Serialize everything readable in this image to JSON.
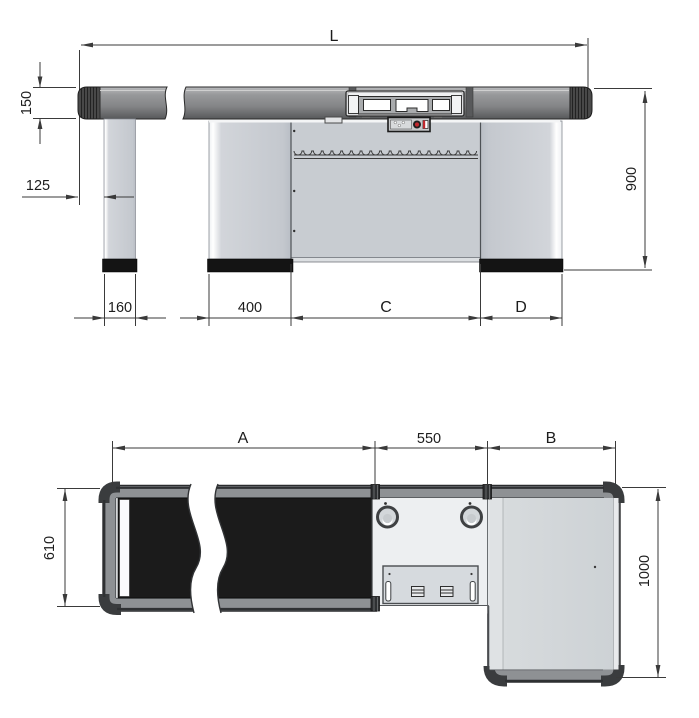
{
  "drawing": {
    "views": {
      "front_elevation": {
        "dims": {
          "overall_length": "L",
          "rail_height": "150",
          "rail_overhang": "125",
          "counter_height": "900",
          "leg_width": "160",
          "left_cabinet_width": "400",
          "center_width": "C",
          "right_cabinet_width": "D"
        }
      },
      "top_plan": {
        "dims": {
          "belt_length": "A",
          "center_section_width": "550",
          "end_section_width": "B",
          "counter_depth": "610",
          "end_depth": "1000"
        }
      }
    },
    "colors": {
      "line": "#3a3a3a",
      "text": "#1c1c1c",
      "bumper": "#8e9194",
      "bumper_dark": "#2f3133",
      "corner": "#3a3c3e",
      "panel": "#c9cdd3",
      "deck": "#e4e7e9",
      "deck_light": "#edeff1",
      "belt": "#1b1b1b",
      "base": "#141414",
      "button_red": "#c1272d"
    }
  }
}
